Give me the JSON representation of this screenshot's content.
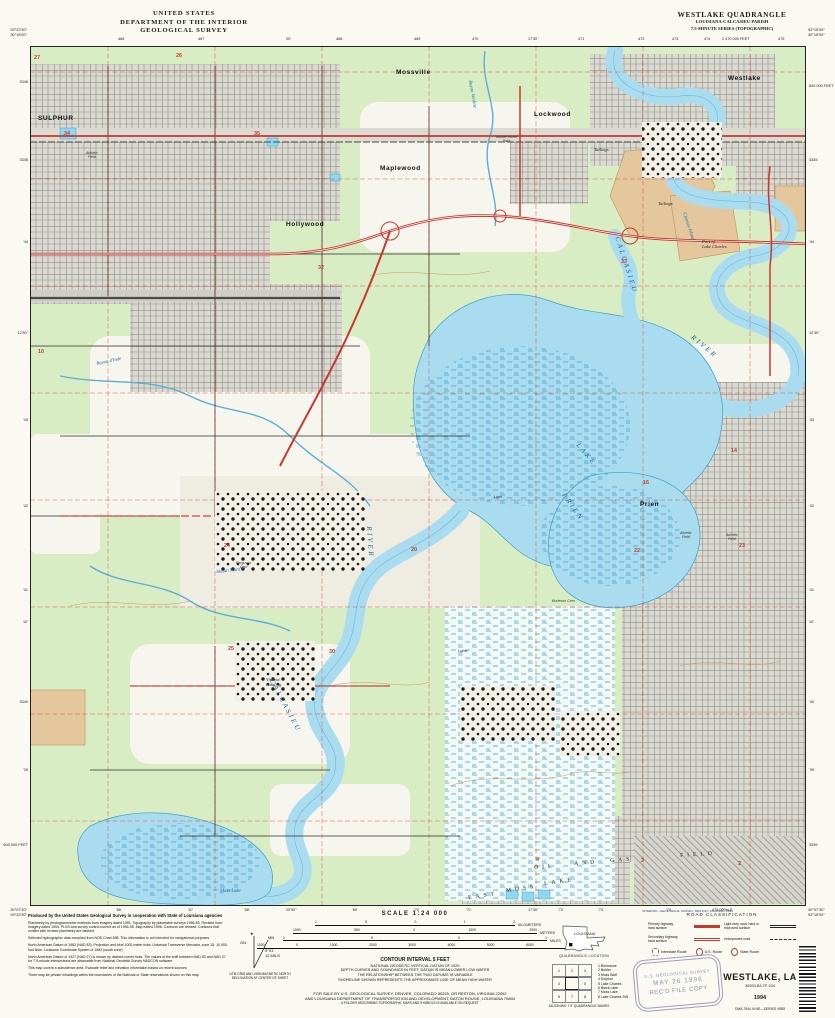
{
  "header": {
    "left": [
      "UNITED STATES",
      "DEPARTMENT OF THE INTERIOR",
      "GEOLOGICAL SURVEY"
    ],
    "right": [
      "WESTLAKE QUADRANGLE",
      "LOUISIANA-CALCASIEU PARISH",
      "7.5-MINUTE SERIES (TOPOGRAPHIC)"
    ]
  },
  "corners": {
    "tl": [
      "93°22'30\"",
      "30°15'00\""
    ],
    "tr": [
      "93°15'00\"",
      "30°15'00\""
    ],
    "bl": [
      "30°07'30\"",
      "93°22'30\""
    ],
    "br": [
      "30°07'30\"",
      "93°15'00\""
    ]
  },
  "edge_ticks": {
    "top": [
      {
        "x": 118,
        "t": "466"
      },
      {
        "x": 198,
        "t": "467"
      },
      {
        "x": 286,
        "t": "20'"
      },
      {
        "x": 336,
        "t": "468"
      },
      {
        "x": 414,
        "t": "469"
      },
      {
        "x": 472,
        "t": "470"
      },
      {
        "x": 528,
        "t": "17'30\""
      },
      {
        "x": 578,
        "t": "471"
      },
      {
        "x": 638,
        "t": "472"
      },
      {
        "x": 672,
        "t": "473"
      },
      {
        "x": 704,
        "t": "474"
      },
      {
        "x": 722,
        "t": "2 470 000 FEET"
      },
      {
        "x": 778,
        "t": "475"
      }
    ],
    "bottom": [
      {
        "x": 116,
        "t": "'66"
      },
      {
        "x": 188,
        "t": "'67"
      },
      {
        "x": 244,
        "t": "'68"
      },
      {
        "x": 286,
        "t": "20'00\""
      },
      {
        "x": 352,
        "t": "'69"
      },
      {
        "x": 414,
        "t": "'70"
      },
      {
        "x": 466,
        "t": "'71"
      },
      {
        "x": 528,
        "t": "17'30\""
      },
      {
        "x": 558,
        "t": "'72"
      },
      {
        "x": 598,
        "t": "'73"
      },
      {
        "x": 666,
        "t": "'74"
      },
      {
        "x": 712,
        "t": "475 000m E"
      }
    ],
    "left": [
      {
        "y": 80,
        "t": "3346"
      },
      {
        "y": 158,
        "t": "3345"
      },
      {
        "y": 240,
        "t": "'44"
      },
      {
        "y": 331,
        "t": "12'30\""
      },
      {
        "y": 418,
        "t": "'43"
      },
      {
        "y": 504,
        "t": "'42"
      },
      {
        "y": 588,
        "t": "'41"
      },
      {
        "y": 620,
        "t": "10'"
      },
      {
        "y": 700,
        "t": "3340"
      },
      {
        "y": 768,
        "t": "'39"
      },
      {
        "y": 843,
        "t": "600 000 FEET"
      }
    ],
    "right": [
      {
        "y": 84,
        "t": "840 000 FEET"
      },
      {
        "y": 158,
        "t": "3345"
      },
      {
        "y": 240,
        "t": "'44"
      },
      {
        "y": 331,
        "t": "12'30\""
      },
      {
        "y": 418,
        "t": "'43"
      },
      {
        "y": 504,
        "t": "'42"
      },
      {
        "y": 588,
        "t": "'41"
      },
      {
        "y": 620,
        "t": "10'"
      },
      {
        "y": 700,
        "t": "'40"
      },
      {
        "y": 768,
        "t": "'39"
      },
      {
        "y": 843,
        "t": "3339"
      }
    ]
  },
  "map": {
    "labels": [
      {
        "t": "SULPHUR",
        "x": 8,
        "y": 70,
        "c": "town"
      },
      {
        "t": "Mossville",
        "x": 366,
        "y": 24,
        "c": "town"
      },
      {
        "t": "Lockwood",
        "x": 504,
        "y": 66,
        "c": "town"
      },
      {
        "t": "Maplewood",
        "x": 350,
        "y": 120,
        "c": "town"
      },
      {
        "t": "Hollywood",
        "x": 256,
        "y": 176,
        "c": "town"
      },
      {
        "t": "Westlake",
        "x": 698,
        "y": 30,
        "c": "town"
      },
      {
        "t": "Prien",
        "x": 610,
        "y": 456,
        "c": "town"
      },
      {
        "t": "Vincent\nLanding",
        "x": 236,
        "y": 632,
        "c": "place"
      },
      {
        "t": "Port of\nLake Charles",
        "x": 672,
        "y": 194,
        "c": "place"
      },
      {
        "t": "Tailings",
        "x": 564,
        "y": 102,
        "c": "place"
      },
      {
        "t": "Tailings",
        "x": 628,
        "y": 156,
        "c": "place"
      },
      {
        "t": "Mobile Home\nPark",
        "x": 466,
        "y": 90,
        "c": "tiny"
      },
      {
        "t": "Athletic\nField",
        "x": 56,
        "y": 106,
        "c": "tiny"
      },
      {
        "t": "Athletic\nField",
        "x": 650,
        "y": 486,
        "c": "tiny"
      },
      {
        "t": "Athletic\nField",
        "x": 696,
        "y": 488,
        "c": "tiny"
      },
      {
        "t": "Ferguson\nCem",
        "x": 206,
        "y": 516,
        "c": "tiny"
      },
      {
        "t": "Burleson Cem",
        "x": 522,
        "y": 554,
        "c": "tiny"
      },
      {
        "t": "Light",
        "x": 464,
        "y": 450,
        "c": "tiny"
      },
      {
        "t": "Lights",
        "x": 428,
        "y": 604,
        "c": "tiny"
      },
      {
        "t": "CALCASIEU",
        "x": 590,
        "y": 190,
        "c": "water-big",
        "r": 72
      },
      {
        "t": "RIVER",
        "x": 664,
        "y": 288,
        "c": "water-big",
        "r": 40
      },
      {
        "t": "RIVER",
        "x": 342,
        "y": 480,
        "c": "water-big",
        "r": 86
      },
      {
        "t": "CALCASIEU",
        "x": 244,
        "y": 632,
        "c": "water-big",
        "r": 62
      },
      {
        "t": "PRIEN",
        "x": 536,
        "y": 446,
        "c": "water-big",
        "r": 55
      },
      {
        "t": "LAKE",
        "x": 550,
        "y": 396,
        "c": "water-big",
        "r": 50
      },
      {
        "t": "Moss  Lake",
        "x": 190,
        "y": 843,
        "c": "water"
      },
      {
        "t": "Bayou Verdine",
        "x": 442,
        "y": 34,
        "c": "water",
        "r": 80
      },
      {
        "t": "Bayou d'Inde",
        "x": 66,
        "y": 316,
        "c": "water",
        "r": -12
      },
      {
        "t": "Indian Marais",
        "x": 186,
        "y": 524,
        "c": "water",
        "r": -6
      },
      {
        "t": "Clooney Island",
        "x": 656,
        "y": 166,
        "c": "water",
        "r": 72
      },
      {
        "t": "EAST",
        "x": 438,
        "y": 850,
        "c": "spread",
        "r": -8
      },
      {
        "t": "MOSS",
        "x": 476,
        "y": 843,
        "c": "spread",
        "r": -8
      },
      {
        "t": "LAKE",
        "x": 514,
        "y": 836,
        "c": "spread",
        "r": -8
      },
      {
        "t": "OIL",
        "x": 504,
        "y": 820,
        "c": "spread",
        "r": -4
      },
      {
        "t": "AND",
        "x": 544,
        "y": 816,
        "c": "spread",
        "r": -4
      },
      {
        "t": "GAS",
        "x": 580,
        "y": 813,
        "c": "spread",
        "r": -4
      },
      {
        "t": "FIELD",
        "x": 650,
        "y": 808,
        "c": "spread",
        "r": -4
      }
    ],
    "sections": [
      {
        "n": "27",
        "x": 4,
        "y": 10
      },
      {
        "n": "26",
        "x": 146,
        "y": 8
      },
      {
        "n": "34",
        "x": 34,
        "y": 86
      },
      {
        "n": "35",
        "x": 224,
        "y": 86
      },
      {
        "n": "10",
        "x": 8,
        "y": 304
      },
      {
        "n": "32",
        "x": 288,
        "y": 220
      },
      {
        "n": "33",
        "x": 591,
        "y": 214
      },
      {
        "n": "24",
        "x": 194,
        "y": 498
      },
      {
        "n": "20",
        "x": 381,
        "y": 502
      },
      {
        "n": "16",
        "x": 613,
        "y": 435
      },
      {
        "n": "14",
        "x": 701,
        "y": 403
      },
      {
        "n": "22",
        "x": 604,
        "y": 503
      },
      {
        "n": "23",
        "x": 709,
        "y": 498
      },
      {
        "n": "25",
        "x": 198,
        "y": 601
      },
      {
        "n": "30",
        "x": 299,
        "y": 604
      },
      {
        "n": "4",
        "x": 506,
        "y": 812
      },
      {
        "n": "3",
        "x": 611,
        "y": 813
      },
      {
        "n": "2",
        "x": 708,
        "y": 816
      }
    ]
  },
  "credits": {
    "paragraphs": [
      "Produced by the United States Geological Survey in cooperation with State of Louisiana agencies",
      "Planimetry by photogrammetric methods from imagery dated 1951. Topography by planetable surveys 1956-55. Revised from imagery dated 1994. PLSS and survey control current as of 1994-95. Map edited 1996. Contours are revised. Contours that conflict with revised planimetry are dashed",
      "Selected hydrographic data compiled from NOS Chart 898. This information is not intended for navigational purposes",
      "North American Datum of 1983 (NAD 83). Projection and blue 1000-meter ticks: Universal Transverse Mercator, zone 15. 10 000-foot ticks: Louisiana Coordinate System of 1983 (south zone)",
      "North American Datum of 1927 (NAD 27) is shown by dashed corner ticks. The values of the shift between NAD 83 and NAD 27 for 7.5-minute intersections are obtainable from National Geodetic Survey NADCON software",
      "This map covers a subsidence area. Evaluate relief and elevation information based on recent sources",
      "There may be private inholdings within the boundaries of the National or State reservations shown on this map"
    ]
  },
  "declination": {
    "gn": "GN",
    "mn": "MN",
    "angle": "0°41'",
    "mils": "12 MILS",
    "note": [
      "UTM GRID AND 1996 MAGNETIC NORTH",
      "DECLINATION AT CENTER OF SHEET"
    ]
  },
  "scale": {
    "title": "SCALE 1:24 000",
    "bars": [
      {
        "unit": "KILOMETERS",
        "ticks": [
          "1",
          ".5",
          "0",
          "1",
          "2"
        ]
      },
      {
        "unit": "METERS",
        "ticks": [
          "1000",
          "500",
          "0",
          "1000",
          "2000"
        ]
      },
      {
        "unit": "MILES",
        "ticks": [
          "1",
          ".5",
          "0",
          "1"
        ]
      },
      {
        "unit": "FEET",
        "ticks": [
          "1000",
          "0",
          "1000",
          "2000",
          "3000",
          "4000",
          "5000",
          "6000",
          "7000"
        ]
      }
    ]
  },
  "contour": {
    "lines": [
      "CONTOUR INTERVAL 5 FEET",
      "NATIONAL GEODETIC VERTICAL DATUM OF 1929",
      "DEPTH CURVES AND SOUNDINGS IN FEET, DATUM IS MEAN LOWER LOW WATER",
      "THE RELATIONSHIP BETWEEN THE TWO DATUMS IS VARIABLE",
      "SHORELINE SHOWN REPRESENTS THE APPROXIMATE LINE OF MEAN HIGH WATER"
    ]
  },
  "sale": {
    "lines": [
      "FOR SALE BY U.S. GEOLOGICAL SURVEY, DENVER, COLORADO 80225, OR RESTON, VIRGINIA 22092",
      "AND LOUISIANA DEPARTMENT OF TRANSPORTATION AND DEVELOPMENT, BATON ROUGE, LOUISIANA 70804",
      "A FOLDER DESCRIBING TOPOGRAPHIC MAPS AND SYMBOLS IS AVAILABLE ON REQUEST"
    ]
  },
  "imprint": "INTERIOR—GEOLOGICAL SURVEY, RESTON, VIRGINIA—1996",
  "road_class": {
    "title": "ROAD CLASSIFICATION",
    "rows": [
      {
        "label": [
          "Primary highway,",
          "hard surface"
        ],
        "style": "primary"
      },
      {
        "label": [
          "Secondary highway,",
          "hard surface"
        ],
        "style": "secondary"
      },
      {
        "label": [
          "Light-duty road, hard or",
          "improved surface"
        ],
        "style": "lightduty"
      },
      {
        "label": [
          "Unimproved road",
          ""
        ],
        "style": "unimproved"
      }
    ],
    "shields": [
      {
        "type": "interstate",
        "label": "Interstate Route"
      },
      {
        "type": "us",
        "label": "U.S. Route"
      },
      {
        "type": "state",
        "label": "State Route"
      }
    ]
  },
  "location": {
    "state": "LOUISIANA",
    "caption": "QUADRANGLE LOCATION"
  },
  "adjoining": {
    "caption": "ADJOINING 7.5' QUADRANGLE NAMES",
    "names": [
      "Brimstone",
      "Buhler",
      "Moss Bluff",
      "Sulphur",
      "Lake Charles",
      "Black Lake",
      "Moss Lake",
      "Lake Charles SW"
    ]
  },
  "stamp": {
    "lines": [
      "U.S. GEOLOGICAL SURVEY",
      "MAY 26 1996",
      "REC'D FILE COPY"
    ]
  },
  "titleblock": {
    "name": "WESTLAKE, LA",
    "code": "30093-B3-TF-024",
    "year": "1994",
    "series": "DMA 7544 III NE—SERIES V885"
  },
  "colors": {
    "water": "#aadcf0",
    "woodland": "#d9edc4",
    "urban": "#dbdad2",
    "highway": "#c9382c",
    "contour": "#c59a66",
    "tailings": "#e5c79e",
    "marsh": "#3f9fc7",
    "grid": "#cf4434"
  }
}
